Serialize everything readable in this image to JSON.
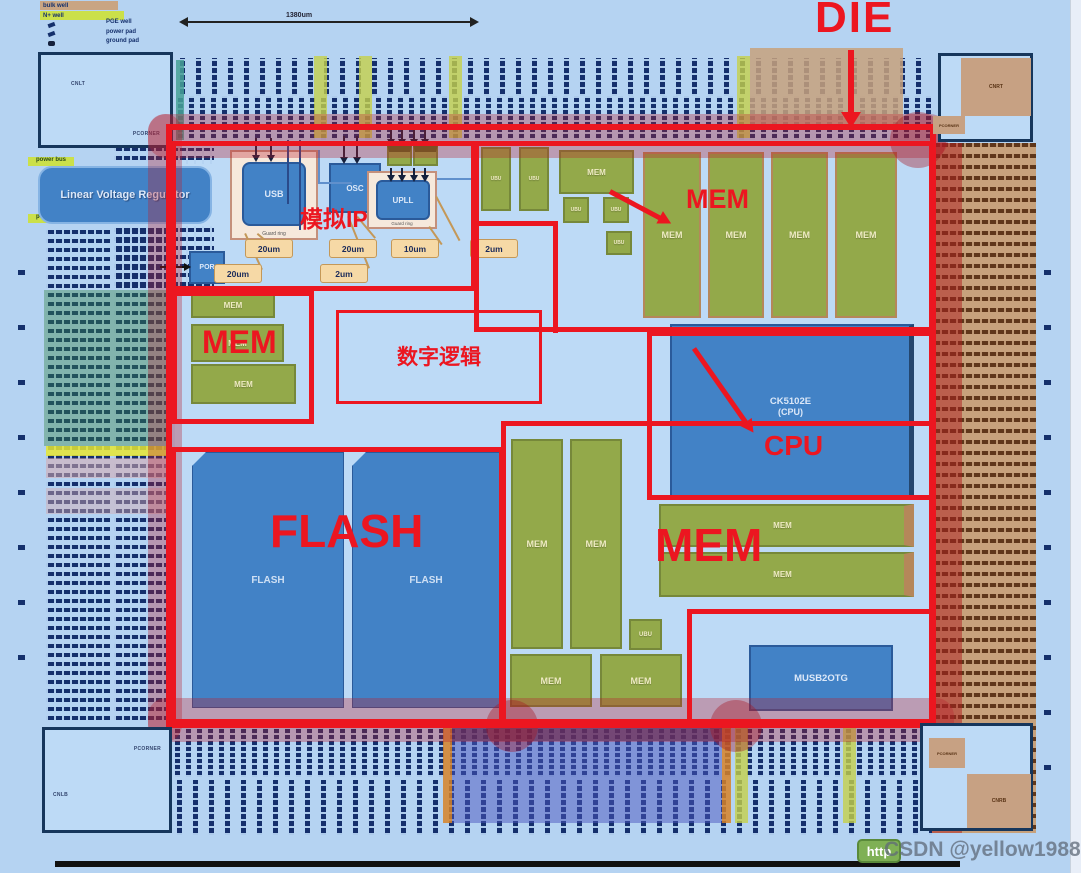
{
  "annotations": {
    "die": "DIE",
    "analog_ip": "模拟IP",
    "digital_logic": "数字逻辑",
    "mem": "MEM",
    "cpu": "CPU",
    "flash": "FLASH"
  },
  "blocks": {
    "lvr": "Linear Voltage Regulator",
    "usb": "USB",
    "osc": "OSC",
    "upll": "UPLL",
    "por": "POR",
    "guard_ring": "Guard ring",
    "mem": "MEM",
    "ubu": "UBU",
    "cpu_name": "CK5102E",
    "cpu_sub": "(CPU)",
    "flash": "FLASH",
    "musb": "MUSB2OTG"
  },
  "callouts": [
    "20um",
    "20um",
    "20um",
    "2um",
    "10um",
    "2um"
  ],
  "corners": {
    "tl": "CNLT",
    "tr": "CNRT",
    "bl": "CNLB",
    "br": "CNRB",
    "pcorner": "PCORNER"
  },
  "legend": {
    "rows": [
      "bulk well",
      "N+ well"
    ],
    "items": [
      "PGE well",
      "power pad",
      "ground pad"
    ]
  },
  "dimension": {
    "width_label": "1380um"
  },
  "side": {
    "power_bus": "power bus"
  },
  "watermark": {
    "badge": "http",
    "text": "CSDN @yellow1988"
  },
  "colors": {
    "annotation_red": "#ec1620",
    "block_blue": "#4282c6",
    "block_green": "#93a94a",
    "pad_tan": "#c7a17c",
    "strip_yellow": "#c3cf46",
    "background": "#b5d3f2"
  }
}
